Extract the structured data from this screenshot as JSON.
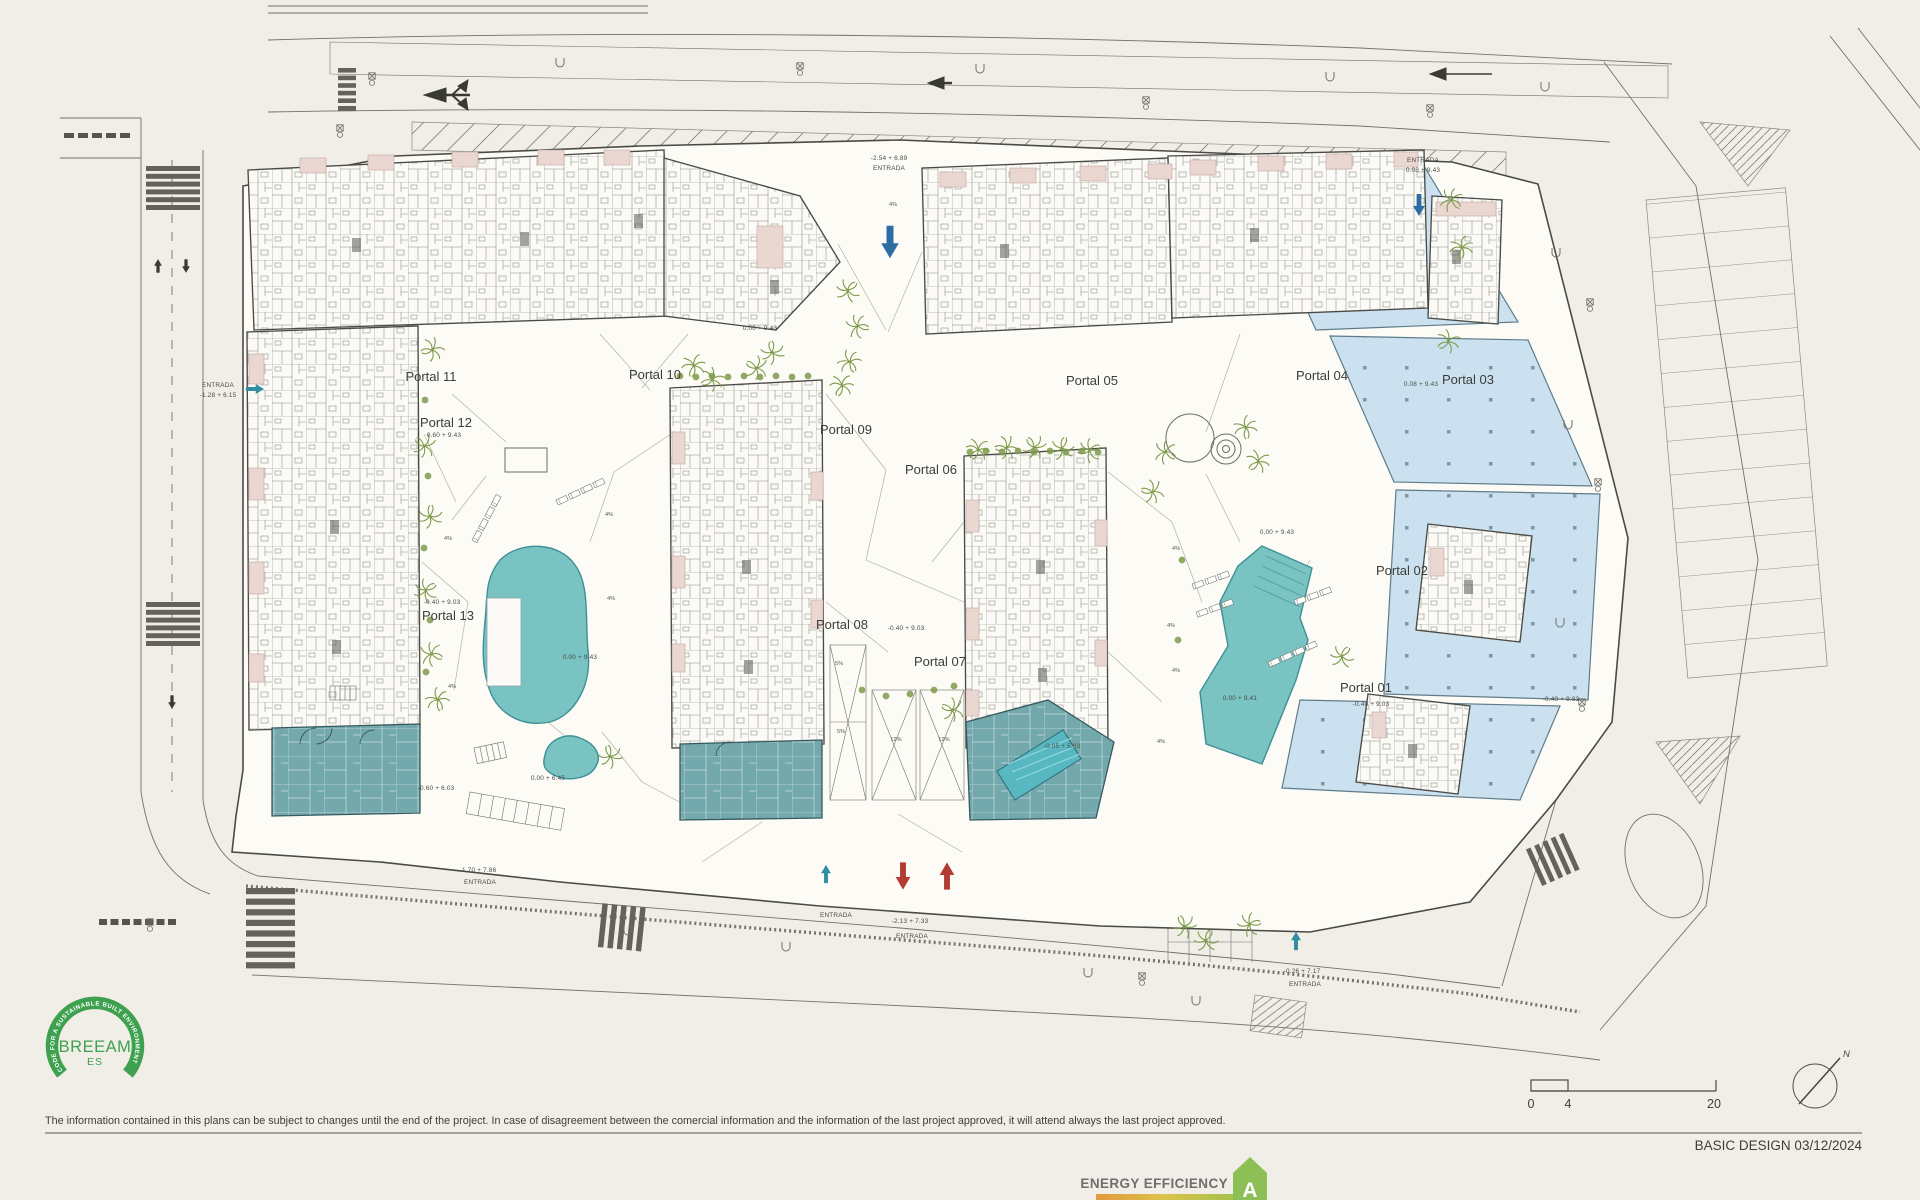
{
  "colors": {
    "paper": "#f1eee7",
    "parcel": "#fcfbf6",
    "line": "#4b4b46",
    "roadline": "#71716a",
    "pool": "#79c3c2",
    "pool_stroke": "#3f8f96",
    "paleblue": "#cbe1ef",
    "paleblue_stroke": "#5e7c8a",
    "amenity": "#73a8ac",
    "amenity_stroke": "#35595d",
    "pink": "#ead7d1",
    "pink_stroke": "#c2a69e",
    "green": "#7d9a4a",
    "arrow_blue": "#2e6da4",
    "arrow_red": "#b23b32",
    "arrow_teal": "#2f8fa0",
    "breeam_green": "#3da14f",
    "badge_green": "#8cbf55",
    "badge_text": "#6e6e6e",
    "strip_orange": "#e39a3d",
    "strip_yellow": "#dcc24b",
    "strip_lime": "#b3c24b",
    "strip_green": "#8cbf55",
    "hatch": "#80807a"
  },
  "footer": {
    "disclaimer": "The information contained in this plans can be subject to changes until the end of the project. In case of disagreement between the comercial information and the information of the last project approved, it will attend always the last project approved.",
    "basic_design": "BASIC DESIGN 03/12/2024"
  },
  "scale_bar": {
    "labels": [
      "0",
      "4",
      "20"
    ]
  },
  "compass": {
    "label": "N"
  },
  "breeam": {
    "arc_text": "CODE FOR A SUSTAINABLE BUILT ENVIRONMENT",
    "name": "BREEAM",
    "region": "ES"
  },
  "energy_badge": {
    "label": "ENERGY EFFICIENCY",
    "rating": "A"
  },
  "plan": {
    "portals": [
      {
        "label": "Portal 01",
        "x": 1366,
        "y": 692
      },
      {
        "label": "Portal 02",
        "x": 1402,
        "y": 575
      },
      {
        "label": "Portal 03",
        "x": 1468,
        "y": 384
      },
      {
        "label": "Portal 04",
        "x": 1322,
        "y": 380
      },
      {
        "label": "Portal 05",
        "x": 1092,
        "y": 385
      },
      {
        "label": "Portal 06",
        "x": 931,
        "y": 474
      },
      {
        "label": "Portal 07",
        "x": 940,
        "y": 666
      },
      {
        "label": "Portal 08",
        "x": 842,
        "y": 629
      },
      {
        "label": "Portal 09",
        "x": 846,
        "y": 434
      },
      {
        "label": "Portal 10",
        "x": 655,
        "y": 379
      },
      {
        "label": "Portal 11",
        "x": 431,
        "y": 381
      },
      {
        "label": "Portal 12",
        "x": 446,
        "y": 427
      },
      {
        "label": "Portal 13",
        "x": 448,
        "y": 620
      }
    ],
    "annotations": [
      {
        "text": "-2.54 + 6.89",
        "x": 889,
        "y": 160
      },
      {
        "text": "ENTRADA",
        "x": 889,
        "y": 170
      },
      {
        "text": "ENTRADA",
        "x": 1423,
        "y": 162
      },
      {
        "text": "0.08 + 9.43",
        "x": 1423,
        "y": 172
      },
      {
        "text": "ENTRADA",
        "x": 218,
        "y": 387
      },
      {
        "text": "-1.28 + 6.15",
        "x": 218,
        "y": 397
      },
      {
        "text": "0.00 + 9.43",
        "x": 760,
        "y": 330
      },
      {
        "text": "0.60 + 9.43",
        "x": 444,
        "y": 437
      },
      {
        "text": "-0.40 + 9.03",
        "x": 442,
        "y": 604
      },
      {
        "text": "0.00 + 9.43",
        "x": 580,
        "y": 659
      },
      {
        "text": "0.00 + 6.45",
        "x": 548,
        "y": 780
      },
      {
        "text": "-0.60 + 6.03",
        "x": 436,
        "y": 790
      },
      {
        "text": "-0.40 + 9.03",
        "x": 906,
        "y": 630
      },
      {
        "text": "0.00 + 9.43",
        "x": 1277,
        "y": 534
      },
      {
        "text": "0.00 + 9.41",
        "x": 1240,
        "y": 700
      },
      {
        "text": "-0.40 + 9.83",
        "x": 1561,
        "y": 701
      },
      {
        "text": "-0.40 + 9.03",
        "x": 1371,
        "y": 706
      },
      {
        "text": "0.08 + 9.43",
        "x": 1421,
        "y": 386
      },
      {
        "text": "-0.05 + 5.83",
        "x": 1062,
        "y": 748
      },
      {
        "text": "ENTRADA",
        "x": 836,
        "y": 917
      },
      {
        "text": "-2.13 + 7.33",
        "x": 910,
        "y": 923
      },
      {
        "text": "ENTRADA",
        "x": 912,
        "y": 938
      },
      {
        "text": "-1.70 + 7.86",
        "x": 478,
        "y": 872
      },
      {
        "text": "ENTRADA",
        "x": 480,
        "y": 884
      },
      {
        "text": "-0.26 + 7.17",
        "x": 1302,
        "y": 973
      },
      {
        "text": "ENTRADA",
        "x": 1305,
        "y": 986
      }
    ],
    "slope_labels": [
      {
        "text": "4%",
        "x": 893,
        "y": 206
      },
      {
        "text": "4%",
        "x": 448,
        "y": 540
      },
      {
        "text": "4%",
        "x": 609,
        "y": 516
      },
      {
        "text": "4%",
        "x": 611,
        "y": 600
      },
      {
        "text": "4%",
        "x": 452,
        "y": 688
      },
      {
        "text": "4%",
        "x": 1176,
        "y": 550
      },
      {
        "text": "4%",
        "x": 1171,
        "y": 627
      },
      {
        "text": "4%",
        "x": 1176,
        "y": 672
      },
      {
        "text": "4%",
        "x": 1161,
        "y": 743
      },
      {
        "text": "5%",
        "x": 839,
        "y": 665
      },
      {
        "text": "5%",
        "x": 841,
        "y": 733
      },
      {
        "text": "12%",
        "x": 896,
        "y": 741
      },
      {
        "text": "12%",
        "x": 944,
        "y": 741
      }
    ],
    "arrows": [
      {
        "dir": "down",
        "x": 890,
        "y": 242,
        "color": "arrow_blue",
        "s": 1.25
      },
      {
        "dir": "down",
        "x": 1419,
        "y": 205,
        "color": "arrow_blue",
        "s": 0.85
      },
      {
        "dir": "right",
        "x": 255,
        "y": 389,
        "color": "arrow_teal",
        "s": 0.7
      },
      {
        "dir": "up",
        "x": 826,
        "y": 874,
        "color": "arrow_teal",
        "s": 0.7
      },
      {
        "dir": "up",
        "x": 1296,
        "y": 941,
        "color": "arrow_teal",
        "s": 0.7
      },
      {
        "dir": "down",
        "x": 903,
        "y": 876,
        "color": "arrow_red",
        "s": 1.05
      },
      {
        "dir": "up",
        "x": 947,
        "y": 876,
        "color": "arrow_red",
        "s": 1.05
      }
    ],
    "trees": [
      [
        694,
        366
      ],
      [
        712,
        380
      ],
      [
        756,
        368
      ],
      [
        772,
        352
      ],
      [
        848,
        290
      ],
      [
        858,
        326
      ],
      [
        850,
        362
      ],
      [
        842,
        386
      ],
      [
        432,
        350
      ],
      [
        424,
        446
      ],
      [
        430,
        516
      ],
      [
        426,
        590
      ],
      [
        432,
        654
      ],
      [
        438,
        700
      ],
      [
        978,
        450
      ],
      [
        1006,
        448
      ],
      [
        1034,
        447
      ],
      [
        1062,
        448
      ],
      [
        1090,
        450
      ],
      [
        1166,
        452
      ],
      [
        1246,
        428
      ],
      [
        1258,
        462
      ],
      [
        1152,
        492
      ],
      [
        1184,
        926
      ],
      [
        1206,
        940
      ],
      [
        1250,
        924
      ],
      [
        1452,
        200
      ],
      [
        1462,
        248
      ],
      [
        1448,
        342
      ],
      [
        952,
        710
      ],
      [
        610,
        756
      ],
      [
        1342,
        656
      ]
    ],
    "bushes": [
      [
        680,
        376
      ],
      [
        696,
        377
      ],
      [
        712,
        376
      ],
      [
        728,
        377
      ],
      [
        744,
        376
      ],
      [
        760,
        377
      ],
      [
        776,
        376
      ],
      [
        792,
        377
      ],
      [
        808,
        376
      ],
      [
        970,
        452
      ],
      [
        986,
        451
      ],
      [
        1002,
        452
      ],
      [
        1018,
        451
      ],
      [
        1034,
        452
      ],
      [
        1050,
        451
      ],
      [
        1066,
        452
      ],
      [
        1082,
        451
      ],
      [
        1098,
        452
      ],
      [
        862,
        690
      ],
      [
        886,
        696
      ],
      [
        910,
        694
      ],
      [
        934,
        690
      ],
      [
        954,
        686
      ],
      [
        425,
        400
      ],
      [
        428,
        476
      ],
      [
        424,
        548
      ],
      [
        430,
        620
      ],
      [
        426,
        672
      ],
      [
        1182,
        560
      ],
      [
        1178,
        640
      ]
    ],
    "loungers": [
      {
        "x": 472,
        "y": 540,
        "rot": -62,
        "n": 4
      },
      {
        "x": 556,
        "y": 500,
        "rot": -25,
        "n": 4
      },
      {
        "x": 1192,
        "y": 584,
        "rot": -20,
        "n": 3
      },
      {
        "x": 1196,
        "y": 612,
        "rot": -20,
        "n": 3
      },
      {
        "x": 1294,
        "y": 600,
        "rot": -20,
        "n": 3
      },
      {
        "x": 1268,
        "y": 662,
        "rot": -24,
        "n": 4
      }
    ],
    "lamps": [
      [
        372,
        76
      ],
      [
        800,
        66
      ],
      [
        1146,
        100
      ],
      [
        1430,
        108
      ],
      [
        150,
        922
      ],
      [
        1142,
        976
      ],
      [
        1590,
        302
      ],
      [
        1598,
        482
      ],
      [
        1582,
        702
      ],
      [
        340,
        128
      ]
    ],
    "drains": [
      [
        560,
        62
      ],
      [
        980,
        68
      ],
      [
        1330,
        76
      ],
      [
        1545,
        86
      ],
      [
        628,
        930
      ],
      [
        786,
        946
      ],
      [
        1088,
        972
      ],
      [
        1196,
        1000
      ],
      [
        1556,
        252
      ],
      [
        1568,
        424
      ],
      [
        1560,
        622
      ]
    ]
  }
}
